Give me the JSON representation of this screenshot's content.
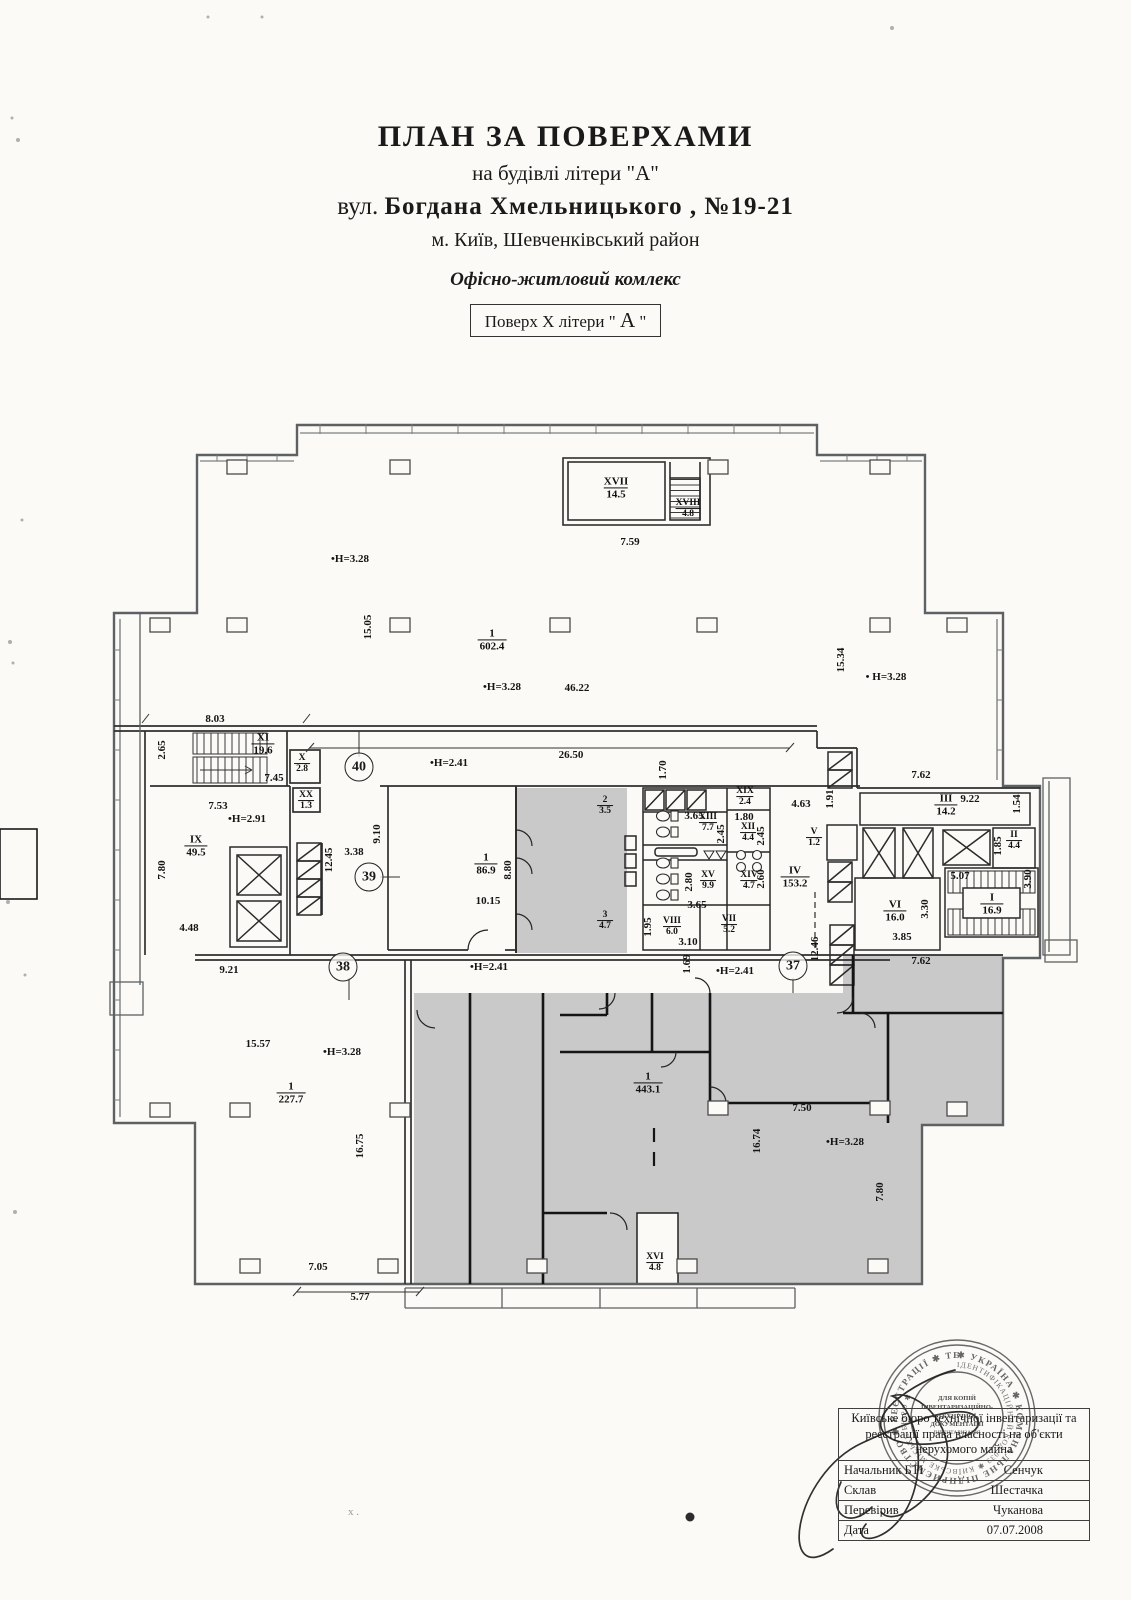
{
  "header": {
    "title": "ПЛАН ЗА ПОВЕРХАМИ",
    "subtitle": "на будівлі літери \"А\"",
    "street_prefix": "вул. ",
    "street_bold": "Богдана Хмельницького ,  №19-21",
    "city": "м. Київ, Шевченківський район",
    "complex": "Офісно-житловий комлекс",
    "floor_box": {
      "prefix": "Поверх X літери \" ",
      "letter": "А",
      "suffix": " \""
    }
  },
  "plan": {
    "rooms": [
      {
        "roman": "XVII",
        "area": "14.5",
        "x": 616,
        "y": 488
      },
      {
        "roman": "XVIII",
        "area": "4.8",
        "x": 688,
        "y": 509,
        "s": 1
      },
      {
        "roman": "1",
        "area": "602.4",
        "x": 492,
        "y": 640
      },
      {
        "roman": "XI",
        "area": "19.6",
        "x": 263,
        "y": 744
      },
      {
        "roman": "X",
        "area": "2.8",
        "x": 302,
        "y": 764,
        "s": 1
      },
      {
        "roman": "XX",
        "area": "1.3",
        "x": 306,
        "y": 801,
        "s": 1
      },
      {
        "roman": "IX",
        "area": "49.5",
        "x": 196,
        "y": 846
      },
      {
        "roman": "1",
        "area": "86.9",
        "x": 486,
        "y": 864
      },
      {
        "roman": "2",
        "area": "3.5",
        "x": 605,
        "y": 806,
        "s": 1
      },
      {
        "roman": "3",
        "area": "4.7",
        "x": 605,
        "y": 921,
        "s": 1
      },
      {
        "roman": "XIX",
        "area": "2.4",
        "x": 745,
        "y": 797,
        "s": 1
      },
      {
        "roman": "XIII",
        "area": "7.7",
        "x": 708,
        "y": 823,
        "s": 1
      },
      {
        "roman": "XII",
        "area": "4.4",
        "x": 748,
        "y": 833,
        "s": 1
      },
      {
        "roman": "XV",
        "area": "9.9",
        "x": 708,
        "y": 881,
        "s": 1
      },
      {
        "roman": "XIV",
        "area": "4.7",
        "x": 749,
        "y": 881,
        "s": 1
      },
      {
        "roman": "V",
        "area": "1.2",
        "x": 814,
        "y": 838,
        "s": 1
      },
      {
        "roman": "IV",
        "area": "153.2",
        "x": 795,
        "y": 877
      },
      {
        "roman": "III",
        "area": "14.2",
        "x": 946,
        "y": 805
      },
      {
        "roman": "II",
        "area": "4.4",
        "x": 1014,
        "y": 841,
        "s": 1
      },
      {
        "roman": "VI",
        "area": "16.0",
        "x": 895,
        "y": 911
      },
      {
        "roman": "I",
        "area": "16.9",
        "x": 992,
        "y": 904
      },
      {
        "roman": "VIII",
        "area": "6.0",
        "x": 672,
        "y": 927,
        "s": 1
      },
      {
        "roman": "VII",
        "area": "5.2",
        "x": 729,
        "y": 925,
        "s": 1
      },
      {
        "roman": "1",
        "area": "227.7",
        "x": 291,
        "y": 1093
      },
      {
        "roman": "1",
        "area": "443.1",
        "x": 648,
        "y": 1083
      },
      {
        "roman": "XVI",
        "area": "4.8",
        "x": 655,
        "y": 1263,
        "s": 1
      }
    ],
    "dims": [
      {
        "t": "7.59",
        "x": 630,
        "y": 542
      },
      {
        "t": "•H=3.28",
        "x": 350,
        "y": 559
      },
      {
        "t": "15.05",
        "x": 368,
        "y": 627,
        "r": 1
      },
      {
        "t": "•H=3.28",
        "x": 502,
        "y": 687
      },
      {
        "t": "46.22",
        "x": 577,
        "y": 688
      },
      {
        "t": "15.34",
        "x": 841,
        "y": 660,
        "r": 1
      },
      {
        "t": "• H=3.28",
        "x": 886,
        "y": 677
      },
      {
        "t": "8.03",
        "x": 215,
        "y": 719
      },
      {
        "t": "2.65",
        "x": 162,
        "y": 750,
        "r": 1
      },
      {
        "t": "7.45",
        "x": 274,
        "y": 778
      },
      {
        "t": "26.50",
        "x": 571,
        "y": 755
      },
      {
        "t": "•H=2.41",
        "x": 449,
        "y": 763
      },
      {
        "t": "1.70",
        "x": 663,
        "y": 770,
        "r": 1
      },
      {
        "t": "7.62",
        "x": 921,
        "y": 775
      },
      {
        "t": "7.53",
        "x": 218,
        "y": 806
      },
      {
        "t": "•H=2.91",
        "x": 247,
        "y": 819
      },
      {
        "t": "7.80",
        "x": 162,
        "y": 870,
        "r": 1
      },
      {
        "t": "12.45",
        "x": 329,
        "y": 860,
        "r": 1
      },
      {
        "t": "3.38",
        "x": 354,
        "y": 852
      },
      {
        "t": "9.10",
        "x": 377,
        "y": 834,
        "r": 1
      },
      {
        "t": "8.80",
        "x": 508,
        "y": 870,
        "r": 1
      },
      {
        "t": "10.15",
        "x": 488,
        "y": 901
      },
      {
        "t": "4.48",
        "x": 189,
        "y": 928
      },
      {
        "t": "9.21",
        "x": 229,
        "y": 970
      },
      {
        "t": "4.63",
        "x": 801,
        "y": 804
      },
      {
        "t": "3.65",
        "x": 694,
        "y": 816
      },
      {
        "t": "1.80",
        "x": 744,
        "y": 817
      },
      {
        "t": "2.45",
        "x": 721,
        "y": 834,
        "r": 1
      },
      {
        "t": "2.45",
        "x": 761,
        "y": 836,
        "r": 1
      },
      {
        "t": "2.80",
        "x": 689,
        "y": 882,
        "r": 1
      },
      {
        "t": "2.60",
        "x": 761,
        "y": 879,
        "r": 1
      },
      {
        "t": "3.65",
        "x": 697,
        "y": 905
      },
      {
        "t": "1.95",
        "x": 648,
        "y": 927,
        "r": 1
      },
      {
        "t": "3.10",
        "x": 688,
        "y": 942
      },
      {
        "t": "1.91",
        "x": 830,
        "y": 799,
        "r": 1
      },
      {
        "t": "9.22",
        "x": 970,
        "y": 799
      },
      {
        "t": "1.54",
        "x": 1017,
        "y": 804,
        "r": 1
      },
      {
        "t": "1.85",
        "x": 998,
        "y": 846,
        "r": 1
      },
      {
        "t": "5.07",
        "x": 960,
        "y": 876
      },
      {
        "t": "3.90",
        "x": 1028,
        "y": 879,
        "r": 1
      },
      {
        "t": "3.30",
        "x": 925,
        "y": 909,
        "r": 1
      },
      {
        "t": "3.85",
        "x": 902,
        "y": 937
      },
      {
        "t": "12.46",
        "x": 815,
        "y": 949,
        "r": 1
      },
      {
        "t": "1.69",
        "x": 687,
        "y": 964,
        "r": 1
      },
      {
        "t": "•H=2.41",
        "x": 735,
        "y": 971
      },
      {
        "t": "•H=2.41",
        "x": 489,
        "y": 967
      },
      {
        "t": "7.62",
        "x": 921,
        "y": 961
      },
      {
        "t": "15.57",
        "x": 258,
        "y": 1044
      },
      {
        "t": "•H=3.28",
        "x": 342,
        "y": 1052
      },
      {
        "t": "16.75",
        "x": 360,
        "y": 1146,
        "r": 1
      },
      {
        "t": "7.05",
        "x": 318,
        "y": 1267
      },
      {
        "t": "5.77",
        "x": 360,
        "y": 1297
      },
      {
        "t": "7.50",
        "x": 802,
        "y": 1108
      },
      {
        "t": "16.74",
        "x": 757,
        "y": 1141,
        "r": 1
      },
      {
        "t": "•H=3.28",
        "x": 845,
        "y": 1142
      },
      {
        "t": "7.80",
        "x": 880,
        "y": 1192,
        "r": 1
      }
    ],
    "markers": [
      {
        "n": "40",
        "x": 359,
        "y": 767
      },
      {
        "n": "39",
        "x": 369,
        "y": 877
      },
      {
        "n": "38",
        "x": 343,
        "y": 967
      },
      {
        "n": "37",
        "x": 793,
        "y": 966
      }
    ]
  },
  "table": {
    "header": "Київське бюро технічної інвентаризації та реєстрації права власності на об'єкти нерухомого майна",
    "rows": [
      {
        "label": "Начальник БТІ",
        "value": "Сенчук"
      },
      {
        "label": "Склав",
        "value": "Шестачка"
      },
      {
        "label": "Перевірив",
        "value": "Чуканова"
      },
      {
        "label": "Дата",
        "value": "07.07.2008"
      }
    ]
  },
  "stamp": {
    "outer": "✱ УКРАЇНА ✱ КОМУНАЛЬНЕ ПІДПРИЄМСТВО ✱ РЕЄСТРАЦІЇ ✱ ТЕХНІЧНОЇ ІНВЕНТАРИЗАЦІЇ ✱ МАЙНА",
    "mid": "ІДЕНТИФІКАЦІЙНИЙ КОД 033 ✱ КИЇВСЬКЕ МІСЬКЕ БЮРО ✱",
    "center1": "ДЛЯ КОПІЙ",
    "center2": "ІНВЕНТАРИЗАЦІЙНО-",
    "center3": "ТЕХНІЧНОЇ",
    "center4": "ДОКУМЕНТАЦІЇ",
    "center5": "ІНВЕНТАРИЗАЦІЯ"
  },
  "misc": {
    "pencil_mark": "х ."
  }
}
